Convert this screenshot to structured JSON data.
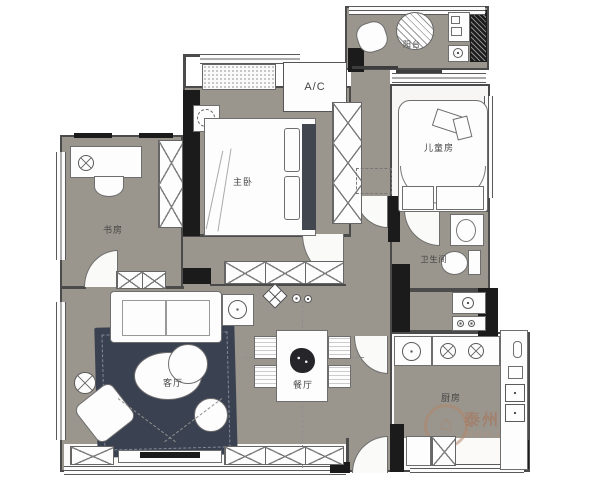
{
  "plan": {
    "rooms": {
      "balcony": "阳台",
      "kids_room": "儿童房",
      "master_bedroom": "主卧",
      "study": "书房",
      "bathroom": "卫生间",
      "kitchen": "厨房",
      "dining_room": "餐厅",
      "living_room": "客厅",
      "ac": "A/C"
    },
    "watermark": {
      "brand": "泰州装",
      "url": "www.t",
      "logo": "⌂"
    }
  }
}
